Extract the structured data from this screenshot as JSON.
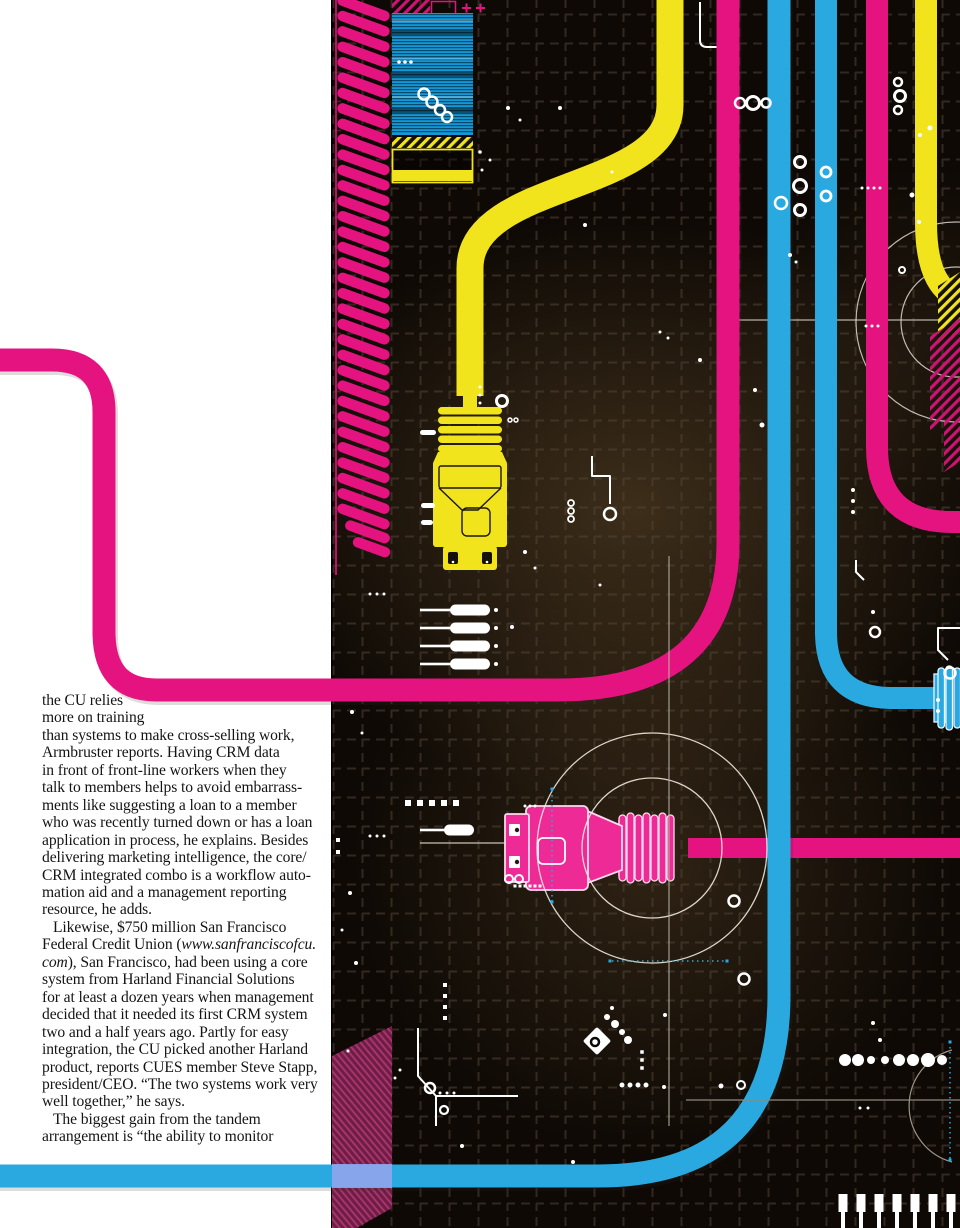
{
  "page": {
    "width": 960,
    "height": 1228,
    "background": "#ffffff"
  },
  "article": {
    "text_color": "#141414",
    "lines": [
      {
        "t": [
          {
            "s": "the CU relies"
          }
        ]
      },
      {
        "t": [
          {
            "s": "more on training"
          }
        ]
      },
      {
        "t": [
          {
            "s": "than systems to make cross-selling work,"
          }
        ]
      },
      {
        "t": [
          {
            "s": "Armbruster reports. Having CRM data"
          }
        ]
      },
      {
        "t": [
          {
            "s": "in front of front-line workers when they"
          }
        ]
      },
      {
        "t": [
          {
            "s": "talk to members helps to avoid embarrass-"
          }
        ]
      },
      {
        "t": [
          {
            "s": "ments like suggesting a loan to a member"
          }
        ]
      },
      {
        "t": [
          {
            "s": "who was recently turned down or has a loan"
          }
        ]
      },
      {
        "t": [
          {
            "s": "application in process, he explains. Besides"
          }
        ]
      },
      {
        "t": [
          {
            "s": "delivering marketing intelligence, the core/"
          }
        ]
      },
      {
        "t": [
          {
            "s": "CRM integrated combo is a workflow auto-"
          }
        ]
      },
      {
        "t": [
          {
            "s": "mation aid and a management reporting"
          }
        ]
      },
      {
        "t": [
          {
            "s": "resource, he adds."
          }
        ]
      },
      {
        "indent": true,
        "t": [
          {
            "s": "Likewise, $750 million San Francisco"
          }
        ]
      },
      {
        "t": [
          {
            "s": "Federal Credit Union ("
          },
          {
            "s": "www.sanfranciscofcu.",
            "it": true
          }
        ]
      },
      {
        "t": [
          {
            "s": "com",
            "it": true
          },
          {
            "s": "), San Francisco, had been using a core"
          }
        ]
      },
      {
        "t": [
          {
            "s": "system from Harland Financial Solutions"
          }
        ]
      },
      {
        "t": [
          {
            "s": "for at least a dozen years when management"
          }
        ]
      },
      {
        "t": [
          {
            "s": "decided that it needed its first CRM system"
          }
        ]
      },
      {
        "t": [
          {
            "s": "two and a half years ago. Partly for easy"
          }
        ]
      },
      {
        "t": [
          {
            "s": "integration, the CU picked another Harland"
          }
        ]
      },
      {
        "t": [
          {
            "s": "product, reports CUES member Steve Stapp,"
          }
        ]
      },
      {
        "t": [
          {
            "s": "president/CEO. “The two systems work very"
          }
        ]
      },
      {
        "t": [
          {
            "s": "well together,” he says."
          }
        ]
      },
      {
        "indent": true,
        "t": [
          {
            "s": "The biggest gain from the tandem"
          }
        ]
      },
      {
        "t": [
          {
            "s": "arrangement is “the ability to monitor"
          }
        ]
      }
    ]
  },
  "illustration": {
    "label": "cmyk-cables-circuit-artwork",
    "colors": {
      "magenta": "#e5137f",
      "magenta_bright": "#ee2a96",
      "cyan": "#2aa9e0",
      "yellow": "#f2e41c",
      "maroon": "#7e2350",
      "maroon_stripe": "#a8336d",
      "panel": "#0e0905",
      "grid": "#55483a",
      "overlap": "#98a5ec",
      "decor_white": "#ffffff",
      "hairline": "#c9c2b2"
    },
    "elements": [
      {
        "name": "yellow-usb-plug-icon"
      },
      {
        "name": "magenta-cable-plug-icon"
      },
      {
        "name": "cyan-edge-plug-icon"
      },
      {
        "name": "hatched-edge-port-icon"
      },
      {
        "name": "chip-pins-icon"
      },
      {
        "name": "magenta-ribbon-icon"
      },
      {
        "name": "scanline-box-icon"
      },
      {
        "name": "hazard-stripe-icon"
      },
      {
        "name": "crosshair-circles-icon"
      }
    ],
    "decor": {
      "dots": [
        [
          508,
          108,
          2
        ],
        [
          520,
          120,
          1.5
        ],
        [
          560,
          108,
          2
        ],
        [
          585,
          225,
          2
        ],
        [
          612,
          172,
          1.5
        ],
        [
          660,
          332,
          1.5
        ],
        [
          668,
          338,
          1.5
        ],
        [
          700,
          360,
          2
        ],
        [
          480,
          387,
          1.5
        ],
        [
          480,
          395,
          1.5
        ],
        [
          480,
          403,
          1.5
        ],
        [
          525,
          552,
          2
        ],
        [
          535,
          568,
          1.5
        ],
        [
          512,
          627,
          2
        ],
        [
          600,
          585,
          1.5
        ],
        [
          370,
          594,
          1.5
        ],
        [
          377,
          594,
          1.5
        ],
        [
          384,
          594,
          1.5
        ],
        [
          370,
          836,
          1.5
        ],
        [
          377,
          836,
          1.5
        ],
        [
          384,
          836,
          1.5
        ],
        [
          352,
          712,
          2
        ],
        [
          362,
          733,
          1.5
        ],
        [
          350,
          893,
          2
        ],
        [
          342,
          930,
          1.5
        ],
        [
          356,
          963,
          2
        ],
        [
          525,
          806,
          1.5
        ],
        [
          530,
          806,
          1.5
        ],
        [
          535,
          806,
          1.5
        ],
        [
          790,
          255,
          2
        ],
        [
          796,
          262,
          1.5
        ],
        [
          755,
          390,
          2
        ],
        [
          762,
          425,
          2.5
        ],
        [
          853,
          490,
          2
        ],
        [
          853,
          501,
          2
        ],
        [
          853,
          512,
          2
        ],
        [
          873,
          612,
          2
        ],
        [
          938,
          700,
          2
        ],
        [
          938,
          711,
          2
        ],
        [
          862,
          188,
          1.5
        ],
        [
          868,
          188,
          1.5
        ],
        [
          874,
          188,
          1.5
        ],
        [
          880,
          188,
          1.5
        ],
        [
          866,
          326,
          1.5
        ],
        [
          872,
          326,
          1.5
        ],
        [
          878,
          326,
          1.5
        ],
        [
          912,
          195,
          2.5
        ],
        [
          919,
          222,
          2
        ],
        [
          920,
          135,
          2
        ],
        [
          930,
          128,
          2.5
        ],
        [
          607,
          1017,
          3
        ],
        [
          615,
          1024,
          4
        ],
        [
          622,
          1032,
          3
        ],
        [
          628,
          1040,
          4
        ],
        [
          612,
          1008,
          2
        ],
        [
          622,
          1085,
          2.5
        ],
        [
          630,
          1085,
          2.5
        ],
        [
          638,
          1085,
          2.5
        ],
        [
          646,
          1085,
          2.5
        ],
        [
          440,
          1093,
          1.5
        ],
        [
          447,
          1093,
          1.5
        ],
        [
          454,
          1093,
          1.5
        ],
        [
          400,
          1070,
          1.5
        ],
        [
          395,
          1078,
          1.5
        ],
        [
          462,
          1146,
          2
        ],
        [
          573,
          1162,
          2
        ],
        [
          664,
          1087,
          2
        ],
        [
          665,
          1015,
          2
        ],
        [
          721,
          1086,
          2.5
        ],
        [
          860,
          1108,
          1.5
        ],
        [
          868,
          1108,
          1.5
        ],
        [
          873,
          1023,
          2
        ],
        [
          880,
          1040,
          2
        ],
        [
          845,
          1060,
          6
        ],
        [
          858,
          1060,
          6
        ],
        [
          871,
          1060,
          4
        ],
        [
          885,
          1060,
          4
        ],
        [
          899,
          1060,
          6
        ],
        [
          913,
          1060,
          6
        ],
        [
          928,
          1060,
          7
        ],
        [
          942,
          1060,
          5
        ],
        [
          348,
          1051,
          1.5
        ],
        [
          399,
          62,
          1.8
        ],
        [
          405,
          62,
          1.8
        ],
        [
          411,
          62,
          1.8
        ],
        [
          480,
          152,
          1.8
        ],
        [
          490,
          160,
          1.5
        ],
        [
          482,
          170,
          1.5
        ]
      ],
      "rings": [
        [
          502,
          401,
          5.5,
          3
        ],
        [
          510,
          420,
          2,
          1.5
        ],
        [
          516,
          420,
          2,
          1.5
        ],
        [
          610,
          514,
          6,
          2.5
        ],
        [
          571,
          503,
          3,
          1.8
        ],
        [
          571,
          511,
          3,
          1.8
        ],
        [
          571,
          519,
          3,
          1.8
        ],
        [
          740,
          103,
          5,
          2.5
        ],
        [
          753,
          103,
          6.5,
          3
        ],
        [
          766,
          103,
          4.5,
          2.5
        ],
        [
          800,
          162,
          5.5,
          3
        ],
        [
          800,
          186,
          6.5,
          3
        ],
        [
          800,
          210,
          5.5,
          3
        ],
        [
          898,
          82,
          4,
          2.5
        ],
        [
          900,
          96,
          5.5,
          3
        ],
        [
          898,
          110,
          4,
          2.5
        ],
        [
          826,
          172,
          5,
          2.8
        ],
        [
          826,
          196,
          5,
          2.8
        ],
        [
          781,
          203,
          6,
          2.5
        ],
        [
          734,
          901,
          5.5,
          2.5
        ],
        [
          744,
          979,
          5.5,
          2.5
        ],
        [
          509,
          879,
          4,
          2
        ],
        [
          519,
          879,
          4,
          2
        ],
        [
          430,
          1088,
          5,
          2.5
        ],
        [
          444,
          1110,
          4,
          2.2
        ],
        [
          741,
          1085,
          4,
          2
        ],
        [
          950,
          673,
          5.5,
          2.5
        ],
        [
          875,
          632,
          5,
          2.5
        ],
        [
          902,
          270,
          3,
          2
        ],
        [
          424,
          94,
          5.5,
          2.5
        ],
        [
          432,
          102,
          5.5,
          2.5
        ],
        [
          440,
          110,
          5,
          2.5
        ],
        [
          447,
          117,
          5,
          2.5
        ]
      ],
      "squares": [
        [
          408,
          803,
          6
        ],
        [
          420,
          803,
          6
        ],
        [
          432,
          803,
          6
        ],
        [
          444,
          803,
          6
        ],
        [
          456,
          803,
          6
        ],
        [
          445,
          985,
          4
        ],
        [
          445,
          996,
          4
        ],
        [
          445,
          1007,
          4
        ],
        [
          445,
          1018,
          4
        ],
        [
          338,
          840,
          4
        ],
        [
          338,
          852,
          4
        ],
        [
          642,
          1052,
          3.5
        ],
        [
          642,
          1060,
          3.5
        ],
        [
          642,
          1068,
          3.5
        ],
        [
          515,
          886,
          3
        ],
        [
          520,
          886,
          3
        ],
        [
          525,
          886,
          3
        ],
        [
          530,
          886,
          3
        ],
        [
          535,
          886,
          3
        ],
        [
          540,
          886,
          3
        ]
      ],
      "cyan_squares": [
        [
          552,
          789,
          3
        ],
        [
          552,
          902,
          3
        ],
        [
          610,
          961,
          3
        ],
        [
          727,
          961,
          3
        ],
        [
          950,
          1042,
          3
        ],
        [
          950,
          1160,
          3
        ]
      ],
      "pins_x": [
        843,
        861,
        879,
        897,
        915,
        933,
        951
      ]
    }
  }
}
